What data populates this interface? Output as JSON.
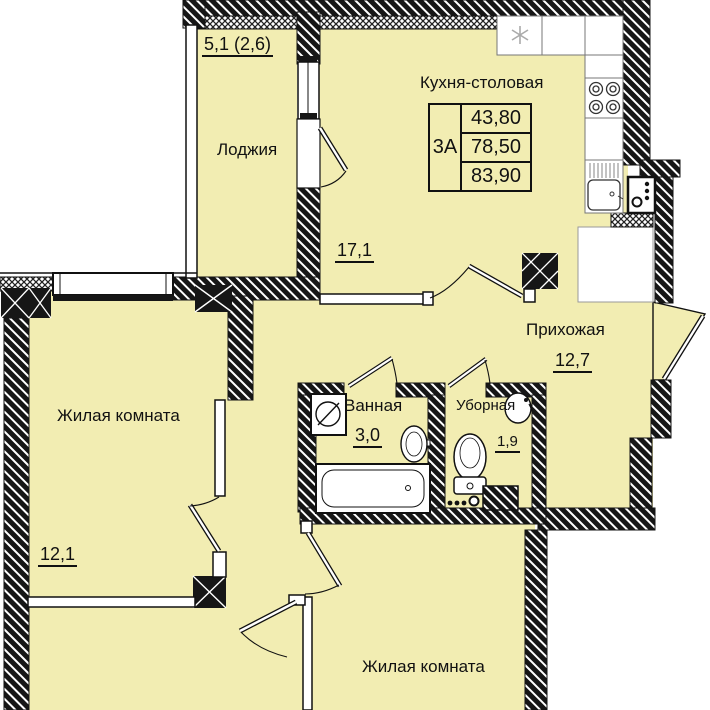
{
  "plan": {
    "unit": {
      "type": "3А",
      "area_living": "43,80",
      "area_total": "78,50",
      "area_total_with_loggia": "83,90"
    },
    "rooms": {
      "loggia": {
        "name": "Лоджия",
        "area": "5,1 (2,6)"
      },
      "kitchen_dining": {
        "name": "Кухня-столовая",
        "area": "17,1"
      },
      "hallway": {
        "name": "Прихожая",
        "area": "12,7"
      },
      "bathroom": {
        "name": "Ванная",
        "area": "3,0"
      },
      "toilet": {
        "name": "Уборная",
        "area": "1,9"
      },
      "living_room_left": {
        "name": "Жилая комната",
        "area": "12,1"
      },
      "living_room_bottom": {
        "name": "Жилая комната"
      }
    },
    "colors": {
      "room_fill": "#F2EDB2",
      "wall": "#161616",
      "background": "#FFFFFF"
    }
  }
}
